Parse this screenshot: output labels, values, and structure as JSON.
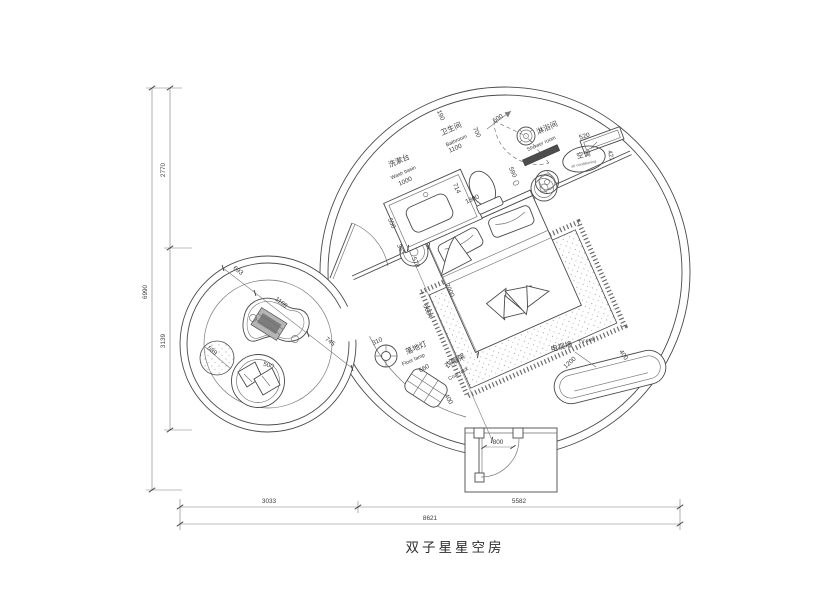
{
  "title": "双子星星空房",
  "colors": {
    "line": "#4a4a4a",
    "text": "#3a3a3a",
    "dark_fill": "#4d4d4d",
    "background": "#ffffff"
  },
  "rooms": {
    "washbasin": {
      "cn": "洗漱台",
      "en": "Wash basin"
    },
    "bathroom": {
      "cn": "卫生间",
      "en": "Bathroom"
    },
    "shower": {
      "cn": "淋浴间",
      "en": "Shower room"
    },
    "ac": {
      "cn": "空调",
      "en": "air conditioning"
    },
    "floor_lamp": {
      "cn": "落地灯",
      "en": "Floor lamp"
    },
    "coat_rack": {
      "cn": "衣帽架",
      "en": "Coat rack"
    },
    "tv_wall": {
      "cn": "电视墙",
      "en": "TV wall"
    }
  },
  "dimensions": {
    "overall_height": "6990",
    "left_upper": "2770",
    "left_lower": "3139",
    "bottom_left": "3033",
    "bottom_right": "5582",
    "overall_width": "8621",
    "small_d1": "693",
    "small_d2": "1166",
    "small_d3": "745",
    "pouf": "589",
    "armchair": "500",
    "lamp": "310",
    "coat_w": "660",
    "coat_d": "400",
    "basin_depth": "550",
    "basin_width": "1000",
    "bath_seg": "190",
    "bath_door": "700",
    "shower_door": "500",
    "bath_width": "1100",
    "toilet": "714",
    "wall_len": "1800",
    "drain": "590",
    "table_a": "363",
    "table_b": "570",
    "bed_width": "2000",
    "room_diag": "5684",
    "ac_width": "520",
    "ac_depth": "421",
    "tv_len": "1200",
    "tv_depth": "400",
    "entry_door": "800"
  }
}
